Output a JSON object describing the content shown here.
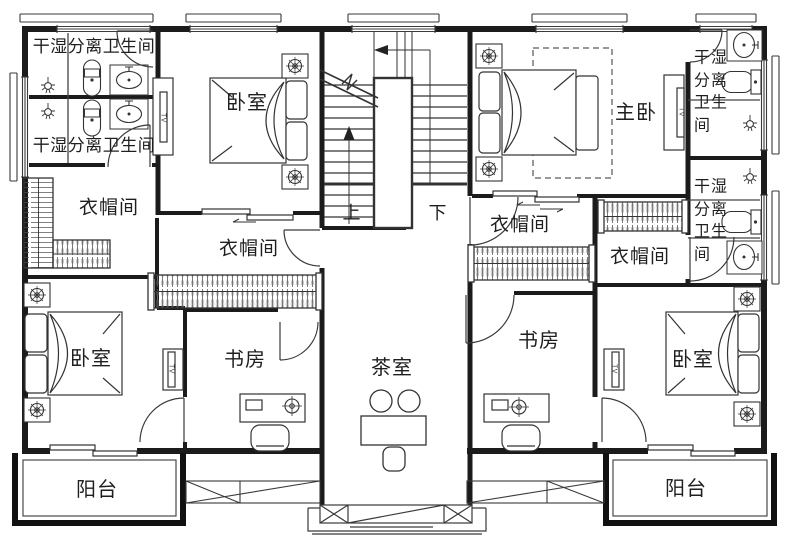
{
  "floor_plan": {
    "labels": {
      "bath_tl_top": "干湿分离卫生间",
      "bath_tl_bottom": "干湿分离卫生间",
      "bath_right_top": "干湿\n分离\n卫生\n间",
      "bath_right_bottom": "干湿\n分离\n卫生\n间",
      "bedroom_top_left": "卧室",
      "master_bedroom": "主卧",
      "closet_left_outer": "衣帽间",
      "closet_left_inner": "衣帽间",
      "closet_right_inner": "衣帽间",
      "closet_right_outer": "衣帽间",
      "stairs_up": "上",
      "stairs_down": "下",
      "bedroom_bottom_left": "卧室",
      "bedroom_bottom_right": "卧室",
      "study_left": "书房",
      "study_right": "书房",
      "tea_room": "茶室",
      "balcony_left": "阳台",
      "balcony_right": "阳台",
      "tv": "TV"
    },
    "colors": {
      "wall": "#1b1b1b",
      "line": "#3a3a3a",
      "background": "#ffffff"
    }
  }
}
